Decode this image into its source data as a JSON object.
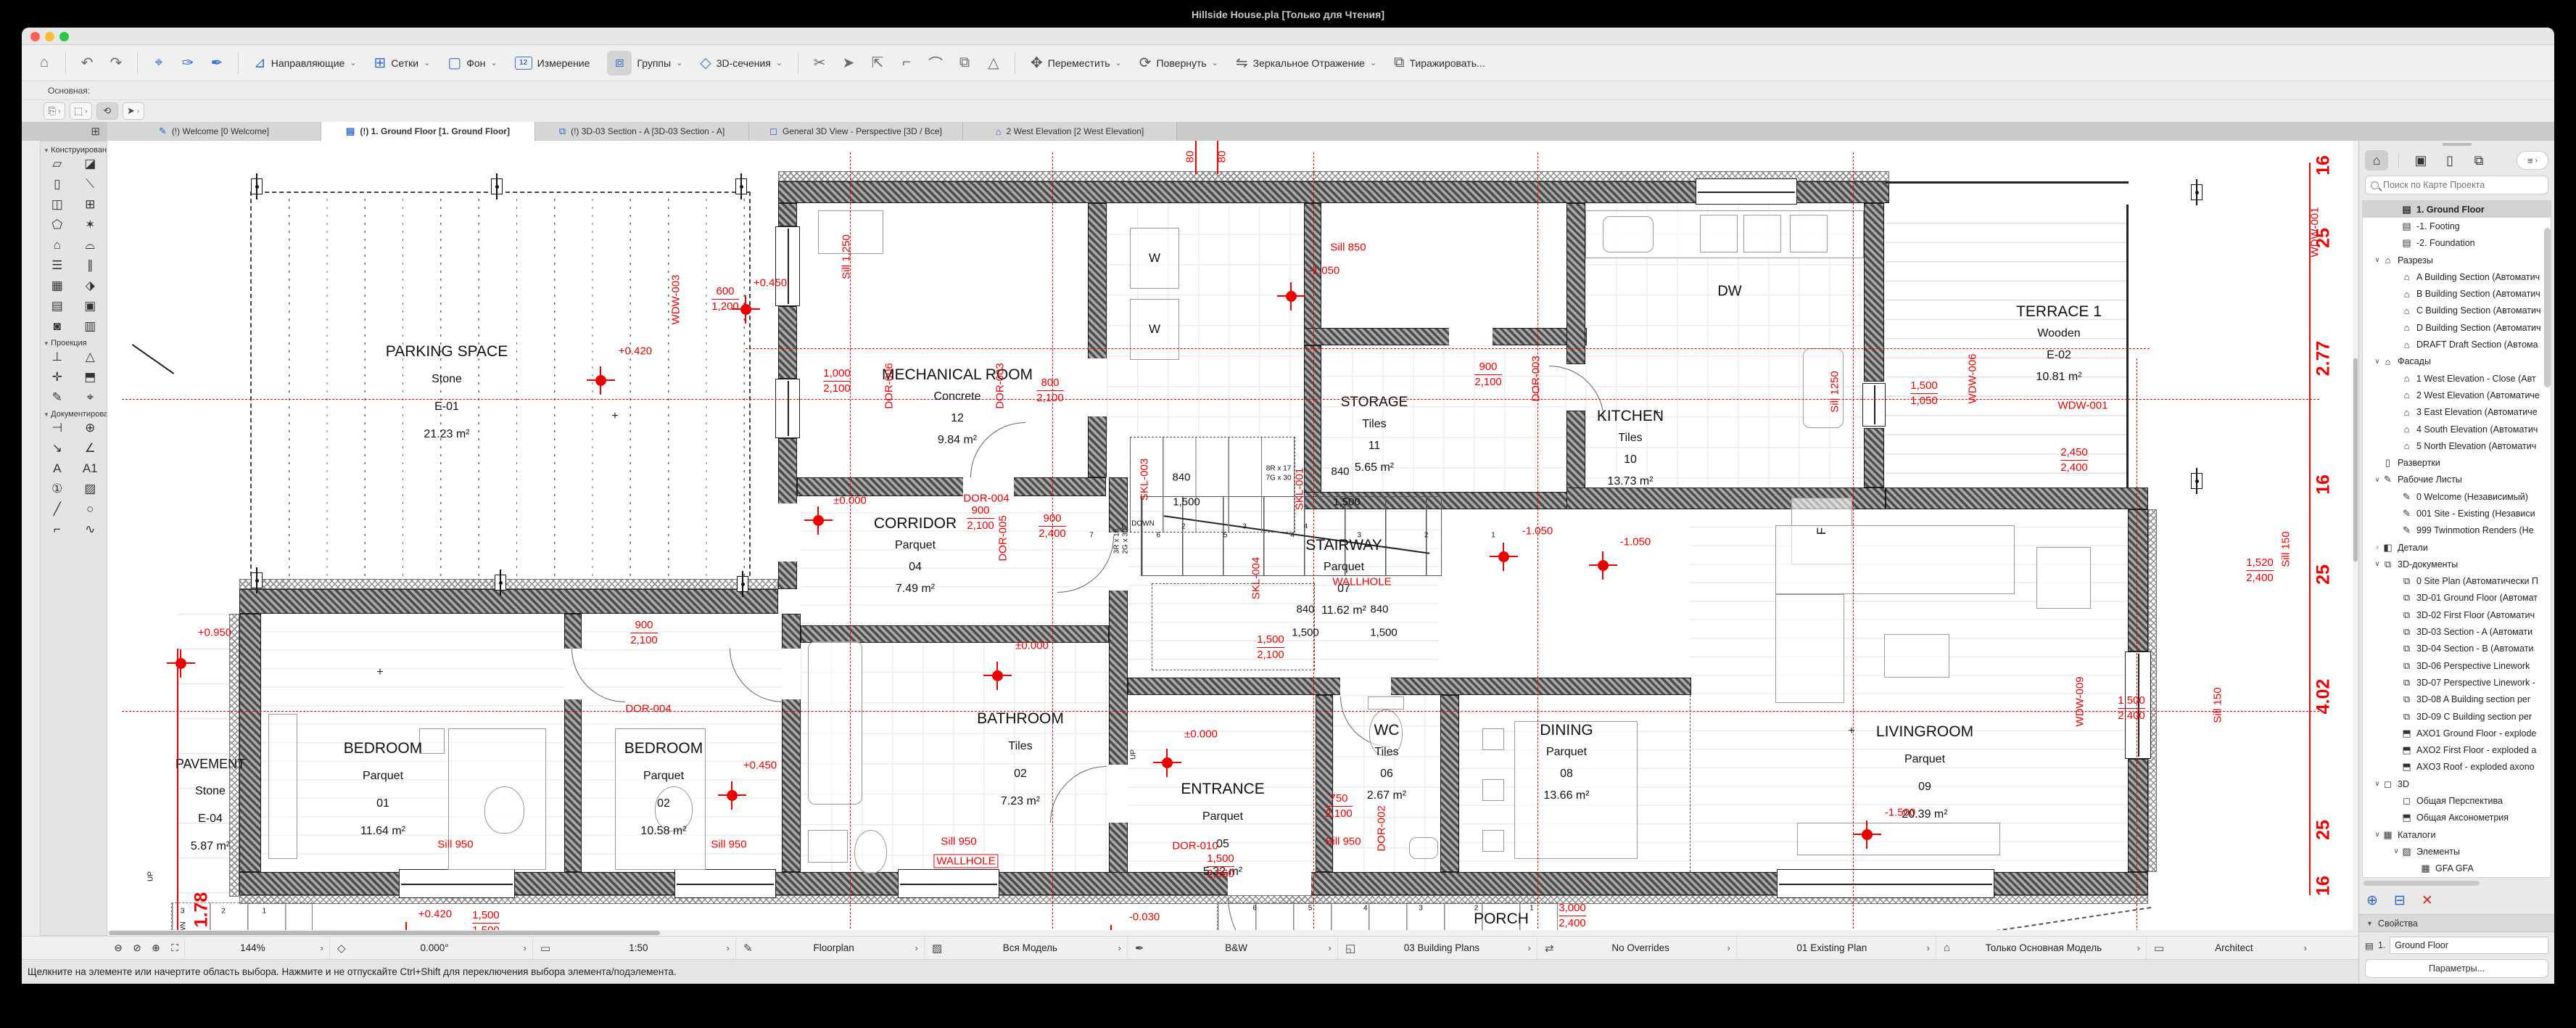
{
  "titlebar": {
    "title": "Hillside House.pla [Только для Чтения]"
  },
  "toolbar": {
    "home": "⌂",
    "undo": "↶",
    "redo": "↷",
    "zoomsel": "⌖",
    "pick1": "✑",
    "pick2": "✒",
    "buttons": [
      {
        "label": "Направляющие",
        "icon": "⊿"
      },
      {
        "label": "Сетки",
        "icon": "⊞"
      },
      {
        "label": "Фон",
        "icon": "▢"
      },
      {
        "label": "Измерение",
        "icon": "12"
      },
      {
        "label": "Группы",
        "icon": "⧈"
      },
      {
        "label": "3D-сечения",
        "icon": "◇"
      }
    ],
    "scissors": "✂",
    "minis": [
      "➤",
      "⇱",
      "⌐",
      "⌒",
      "⧉",
      "△"
    ],
    "edit_buttons": [
      {
        "label": "Переместить",
        "icon": "✥"
      },
      {
        "label": "Повернуть",
        "icon": "⟳"
      },
      {
        "label": "Зеркальное Отражение",
        "icon": "⇋"
      },
      {
        "label": "Тиражировать...",
        "icon": "⧉"
      }
    ],
    "subrow_label": "Основная:",
    "widgets": [
      "⎘",
      "⬚",
      "⟲",
      "➤"
    ]
  },
  "tabs": [
    {
      "icon": "✎",
      "label": "(!) Welcome [0 Welcome]",
      "active": false
    },
    {
      "icon": "▤",
      "label": "(!) 1. Ground Floor [1. Ground Floor]",
      "active": true
    },
    {
      "icon": "⧉",
      "label": "(!) 3D-03 Section - A [3D-03 Section - A]",
      "active": false
    },
    {
      "icon": "◻",
      "label": "General 3D View - Perspective [3D / Все]",
      "active": false
    },
    {
      "icon": "⌂",
      "label": "2 West Elevation [2 West Elevation]",
      "active": false
    }
  ],
  "tab_overview_icon": "⊞",
  "palette": {
    "sections": [
      {
        "title": "Конструирование",
        "tools": [
          {
            "n": "wall-tool",
            "g": "▱"
          },
          {
            "n": "slab-tool",
            "g": "◪"
          },
          {
            "n": "column-tool",
            "g": "▯"
          },
          {
            "n": "beam-tool",
            "g": "⟍"
          },
          {
            "n": "door-tool",
            "g": "◫"
          },
          {
            "n": "window-tool",
            "g": "⊞"
          },
          {
            "n": "object-tool",
            "g": "⬠"
          },
          {
            "n": "lamp-tool",
            "g": "✶"
          },
          {
            "n": "roof-tool",
            "g": "⌂"
          },
          {
            "n": "shell-tool",
            "g": "⌓"
          },
          {
            "n": "stair-tool",
            "g": "☰"
          },
          {
            "n": "railing-tool",
            "g": "∥"
          },
          {
            "n": "curtainwall-tool",
            "g": "▦"
          },
          {
            "n": "morph-tool",
            "g": "⬗"
          },
          {
            "n": "mesh-tool",
            "g": "▤"
          },
          {
            "n": "zone-tool",
            "g": "▣"
          },
          {
            "n": "opening-tool",
            "g": "◙"
          },
          {
            "n": "marker-tool",
            "g": "▥"
          }
        ]
      },
      {
        "title": "Проекция",
        "tools": [
          {
            "n": "section-tool",
            "g": "⊥"
          },
          {
            "n": "elevation-tool",
            "g": "△"
          },
          {
            "n": "interior-elevation-tool",
            "g": "✛"
          },
          {
            "n": "3d-document-tool",
            "g": "⬒"
          },
          {
            "n": "worksheet-tool",
            "g": "✎"
          },
          {
            "n": "camera-tool",
            "g": "⌖"
          }
        ]
      },
      {
        "title": "Документирование",
        "tools": [
          {
            "n": "dimension-tool",
            "g": "⊣"
          },
          {
            "n": "level-dimension-tool",
            "g": "⊕"
          },
          {
            "n": "radial-dimension-tool",
            "g": "↘"
          },
          {
            "n": "angle-dimension-tool",
            "g": "∠"
          },
          {
            "n": "text-tool",
            "g": "A"
          },
          {
            "n": "label-tool",
            "g": "A1"
          },
          {
            "n": "zone-stamp-tool",
            "g": "①"
          },
          {
            "n": "fill-tool",
            "g": "▨"
          },
          {
            "n": "line-tool",
            "g": "╱"
          },
          {
            "n": "circle-tool",
            "g": "○"
          },
          {
            "n": "polyline-tool",
            "g": "⌐"
          },
          {
            "n": "spline-tool",
            "g": "∿"
          }
        ]
      }
    ]
  },
  "plan": {
    "rooms": [
      {
        "n": "PARKING SPACE",
        "m": "Stone",
        "u": "E-01",
        "a": "21.23 m²"
      },
      {
        "n": "MECHANICAL ROOM",
        "m": "Concrete",
        "u": "12",
        "a": "9.84 m²"
      },
      {
        "n": "STORAGE",
        "m": "Tiles",
        "u": "11",
        "a": "5.65 m²"
      },
      {
        "n": "KITCHEN",
        "m": "Tiles",
        "u": "10",
        "a": "13.73 m²"
      },
      {
        "n": "TERRACE 1",
        "m": "Wooden",
        "u": "E-02",
        "a": "10.81 m²"
      },
      {
        "n": "CORRIDOR",
        "m": "Parquet",
        "u": "04",
        "a": "7.49 m²"
      },
      {
        "n": "STAIRWAY",
        "m": "Parquet",
        "u": "07",
        "a": "11.62 m²"
      },
      {
        "n": "BEDROOM",
        "m": "Parquet",
        "u": "01",
        "a": "11.64 m²"
      },
      {
        "n": "BEDROOM",
        "m": "Parquet",
        "u": "02",
        "a": "10.58 m²"
      },
      {
        "n": "BATHROOM",
        "m": "Tiles",
        "u": "02",
        "a": "7.23 m²"
      },
      {
        "n": "ENTRANCE",
        "m": "Parquet",
        "u": "05",
        "a": "5.32 m²"
      },
      {
        "n": "WC",
        "m": "Tiles",
        "u": "06",
        "a": "2.67 m²"
      },
      {
        "n": "DINING",
        "m": "Parquet",
        "u": "08",
        "a": "13.66 m²"
      },
      {
        "n": "LIVINGROOM",
        "m": "Parquet",
        "u": "09",
        "a": "20.39 m²"
      },
      {
        "n": "PAVEMENT",
        "m": "Stone",
        "u": "E-04",
        "a": "5.87 m²"
      },
      {
        "n": "PORCH",
        "m": "Stone"
      }
    ],
    "ann": [
      "+0.420",
      "+0.450",
      "+0.450",
      "+0.950",
      "±0.000",
      "±0.000",
      "±0.000",
      "-1.050",
      "-1.050",
      "-1.050",
      "-1.500",
      "-0.030",
      "+0.420",
      "Sill 850",
      "Sill 950",
      "Sill 950",
      "Sill 950",
      "Sill 950",
      "WALLHOLE",
      "WALLHOLE",
      "WDW-001",
      "DOR-004",
      "DOR-004",
      "DOR-010",
      "Sill 1,250",
      "Sill 1250",
      "Sill 150",
      "Sill 150",
      "WDW-003",
      "WDW-006",
      "WDW-001",
      "WDW-009",
      "DOR-006",
      "DOR-003",
      "DOR-003",
      "DOR-005",
      "DOR-002",
      "SKL-003",
      "SKL-001",
      "SKL-004",
      "80",
      "80",
      "1.78",
      "16",
      "25",
      "2.77",
      "16",
      "25",
      "4.02",
      "25",
      "16",
      "840",
      "1,500",
      "840",
      "1,500",
      "840",
      "1,500",
      "840",
      "1,500",
      "8R x 17",
      "7G x 30",
      "3R x 15",
      "2G x 30",
      "6R x 17",
      "5G x 30",
      "3R x 18",
      "2G x 30",
      "2G x 30",
      "2G x 30",
      "DOWN",
      "UP",
      "DOWN",
      "UP",
      "DW",
      "W",
      "W",
      "F",
      "7 6 5 4 3 2 1",
      "6 5 4 3 2 1",
      "1 2 3 4",
      "3 2 1"
    ],
    "dims": [
      {
        "a": "600",
        "b": "1,200"
      },
      {
        "a": "1,000",
        "b": "2,100"
      },
      {
        "a": "800",
        "b": "2,100"
      },
      {
        "a": "900",
        "b": "2,400"
      },
      {
        "a": "900",
        "b": "2,100"
      },
      {
        "a": "750",
        "b": "2,100"
      },
      {
        "a": "1,500",
        "b": "1,050"
      },
      {
        "a": "1,500",
        "b": "2,400"
      },
      {
        "a": "1,520",
        "b": "2,400"
      },
      {
        "a": "3,000",
        "b": "2,400"
      },
      {
        "a": "900",
        "b": "2,100"
      },
      {
        "a": "900",
        "b": "2,100"
      },
      {
        "a": "2,450",
        "b": "2,400"
      },
      {
        "a": "1,500",
        "b": "2,100"
      },
      {
        "a": "1,500",
        "b": "2,550"
      },
      {
        "a": "1,500",
        "b": "1,500"
      }
    ]
  },
  "navigator": {
    "icons": {
      "project": "⌂",
      "views": "▣",
      "layouts": "▯",
      "publisher": "⧉",
      "menu": "≡"
    },
    "search_placeholder": "Поиск по Карте Проекта",
    "tree": [
      {
        "i": "▤",
        "t": "1. Ground Floor",
        "l": 2,
        "c": "",
        "sel": true
      },
      {
        "i": "▤",
        "t": "-1. Footing",
        "l": 2,
        "c": ""
      },
      {
        "i": "▤",
        "t": "-2. Foundation",
        "l": 2,
        "c": ""
      },
      {
        "i": "⌂",
        "t": "Разрезы",
        "l": 1,
        "c": "∨"
      },
      {
        "i": "⌂",
        "t": "A Building Section (Автоматич",
        "l": 2,
        "c": ""
      },
      {
        "i": "⌂",
        "t": "B Building Section (Автоматич",
        "l": 2,
        "c": ""
      },
      {
        "i": "⌂",
        "t": "C Building Section (Автоматич",
        "l": 2,
        "c": ""
      },
      {
        "i": "⌂",
        "t": "D Building Section (Автоматич",
        "l": 2,
        "c": ""
      },
      {
        "i": "⌂",
        "t": "DRAFT Draft Section (Автома",
        "l": 2,
        "c": ""
      },
      {
        "i": "⌂",
        "t": "Фасады",
        "l": 1,
        "c": "∨"
      },
      {
        "i": "⌂",
        "t": "1 West Elevation - Close (Авт",
        "l": 2,
        "c": ""
      },
      {
        "i": "⌂",
        "t": "2 West Elevation (Автоматиче",
        "l": 2,
        "c": ""
      },
      {
        "i": "⌂",
        "t": "3 East Elevation (Автоматиче",
        "l": 2,
        "c": ""
      },
      {
        "i": "⌂",
        "t": "4 South Elevation (Автоматич",
        "l": 2,
        "c": ""
      },
      {
        "i": "⌂",
        "t": "5 North Elevation (Автоматич",
        "l": 2,
        "c": ""
      },
      {
        "i": "▯",
        "t": "Развертки",
        "l": 1,
        "c": ""
      },
      {
        "i": "✎",
        "t": "Рабочие Листы",
        "l": 1,
        "c": "∨"
      },
      {
        "i": "✎",
        "t": "0 Welcome (Независимый)",
        "l": 2,
        "c": ""
      },
      {
        "i": "✎",
        "t": "001 Site - Existing (Независи",
        "l": 2,
        "c": ""
      },
      {
        "i": "✎",
        "t": "999 Twinmotion Renders (Не",
        "l": 2,
        "c": ""
      },
      {
        "i": "◧",
        "t": "Детали",
        "l": 1,
        "c": "›"
      },
      {
        "i": "⧉",
        "t": "3D-документы",
        "l": 1,
        "c": "∨"
      },
      {
        "i": "⧉",
        "t": "0 Site Plan (Автоматически П",
        "l": 2,
        "c": ""
      },
      {
        "i": "⧉",
        "t": "3D-01 Ground Floor (Автомат",
        "l": 2,
        "c": ""
      },
      {
        "i": "⧉",
        "t": "3D-02 First Floor (Автоматич",
        "l": 2,
        "c": ""
      },
      {
        "i": "⧉",
        "t": "3D-03 Section - A (Автомати",
        "l": 2,
        "c": ""
      },
      {
        "i": "⧉",
        "t": "3D-04 Section - B (Автомати",
        "l": 2,
        "c": ""
      },
      {
        "i": "⧉",
        "t": "3D-06 Perspective Linework",
        "l": 2,
        "c": ""
      },
      {
        "i": "⧉",
        "t": "3D-07 Perspective Linework -",
        "l": 2,
        "c": ""
      },
      {
        "i": "⧉",
        "t": "3D-08 A Building section per",
        "l": 2,
        "c": ""
      },
      {
        "i": "⧉",
        "t": "3D-09 C Building section per",
        "l": 2,
        "c": ""
      },
      {
        "i": "⬒",
        "t": "AXO1 Ground Floor - explode",
        "l": 2,
        "c": ""
      },
      {
        "i": "⬒",
        "t": "AXO2 First Floor - exploded a",
        "l": 2,
        "c": ""
      },
      {
        "i": "⬒",
        "t": "AXO3 Roof - exploded axono",
        "l": 2,
        "c": ""
      },
      {
        "i": "◻",
        "t": "3D",
        "l": 1,
        "c": "∨"
      },
      {
        "i": "◻",
        "t": "Общая Перспектива",
        "l": 2,
        "c": ""
      },
      {
        "i": "⬒",
        "t": "Общая Аксонометрия",
        "l": 2,
        "c": ""
      },
      {
        "i": "▦",
        "t": "Каталоги",
        "l": 1,
        "c": "∨"
      },
      {
        "i": "▨",
        "t": "Элементы",
        "l": 2,
        "c": "∨"
      },
      {
        "i": "▦",
        "t": "GFA GFA",
        "l": 3,
        "c": ""
      }
    ],
    "btns": {
      "add": "⊕",
      "card": "⊟",
      "del": "✕"
    },
    "props": {
      "header": "Свойства",
      "story_num": "1.",
      "story_name": "Ground Floor",
      "params": "Параметры...",
      "brand": "GRAPHISOFT ID"
    }
  },
  "statusbar": {
    "segments": [
      {
        "ic": "",
        "l": "144%"
      },
      {
        "ic": "◇",
        "l": "0.000°"
      },
      {
        "ic": "▭",
        "l": "1:50"
      },
      {
        "ic": "✎",
        "l": "Floorplan"
      },
      {
        "ic": "▨",
        "l": "Вся Модель"
      },
      {
        "ic": "✒",
        "l": "B&W"
      },
      {
        "ic": "◱",
        "l": "03 Building Plans"
      },
      {
        "ic": "⇄",
        "l": "No Overrides"
      },
      {
        "ic": "",
        "l": "01 Existing Plan"
      },
      {
        "ic": "⌂",
        "l": "Только Основная Модель"
      },
      {
        "ic": "▭",
        "l": "Architect"
      }
    ]
  },
  "hint": {
    "text": "Щелкните на элементе или начертите область выбора. Нажмите и не отпускайте Ctrl+Shift для переключения выбора элемента/подэлемента."
  }
}
